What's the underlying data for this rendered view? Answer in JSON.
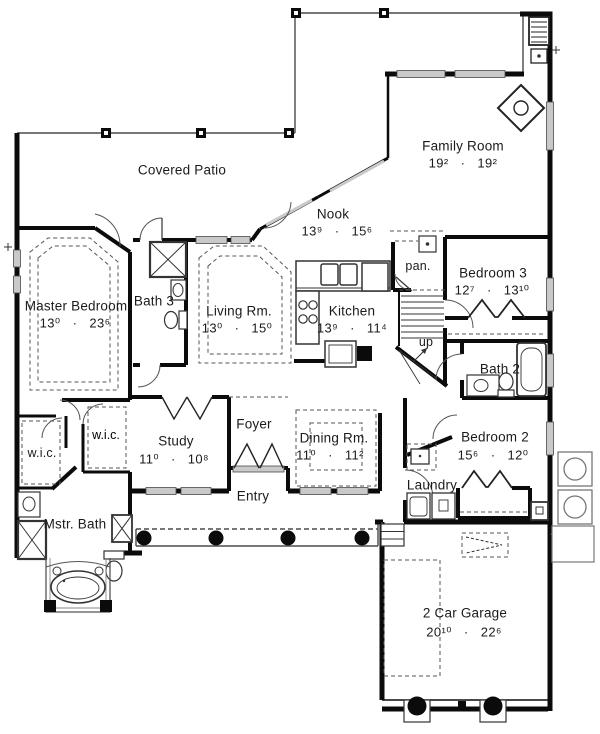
{
  "colors": {
    "wall": "#0b0b0b",
    "thin_line": "#555555",
    "window_fill": "#c9c9c9",
    "background": "#ffffff"
  },
  "rooms": {
    "covered_patio": {
      "label": "Covered Patio"
    },
    "family_room": {
      "label": "Family Room",
      "dims": "19²   ·   19²"
    },
    "nook": {
      "label": "Nook",
      "dims": "13⁹   ·   15⁶"
    },
    "pantry": {
      "label": "pan."
    },
    "bedroom3": {
      "label": "Bedroom 3",
      "dims": "12⁷   ·   13¹⁰"
    },
    "master_bedroom": {
      "label": "Master Bedroom",
      "dims": "13⁰   ·   23⁶"
    },
    "bath3": {
      "label": "Bath 3"
    },
    "living_room": {
      "label": "Living Rm.",
      "dims": "13⁰   ·   15⁰"
    },
    "kitchen": {
      "label": "Kitchen",
      "dims": "13⁹   ·   11⁴"
    },
    "stairs": {
      "label": "up"
    },
    "bath2": {
      "label": "Bath 2"
    },
    "wic_left": {
      "label": "w.i.c."
    },
    "wic_right": {
      "label": "w.i.c."
    },
    "study": {
      "label": "Study",
      "dims": "11⁰   ·   10⁸"
    },
    "foyer": {
      "label": "Foyer"
    },
    "dining_room": {
      "label": "Dining Rm.",
      "dims": "11⁰   ·   11²"
    },
    "entry": {
      "label": "Entry"
    },
    "bedroom2": {
      "label": "Bedroom 2",
      "dims": "15⁶   ·   12⁰"
    },
    "laundry": {
      "label": "Laundry"
    },
    "master_bath": {
      "label": "Mstr. Bath"
    },
    "garage": {
      "label": "2 Car Garage",
      "dims": "20¹⁰   ·   22⁶"
    }
  }
}
